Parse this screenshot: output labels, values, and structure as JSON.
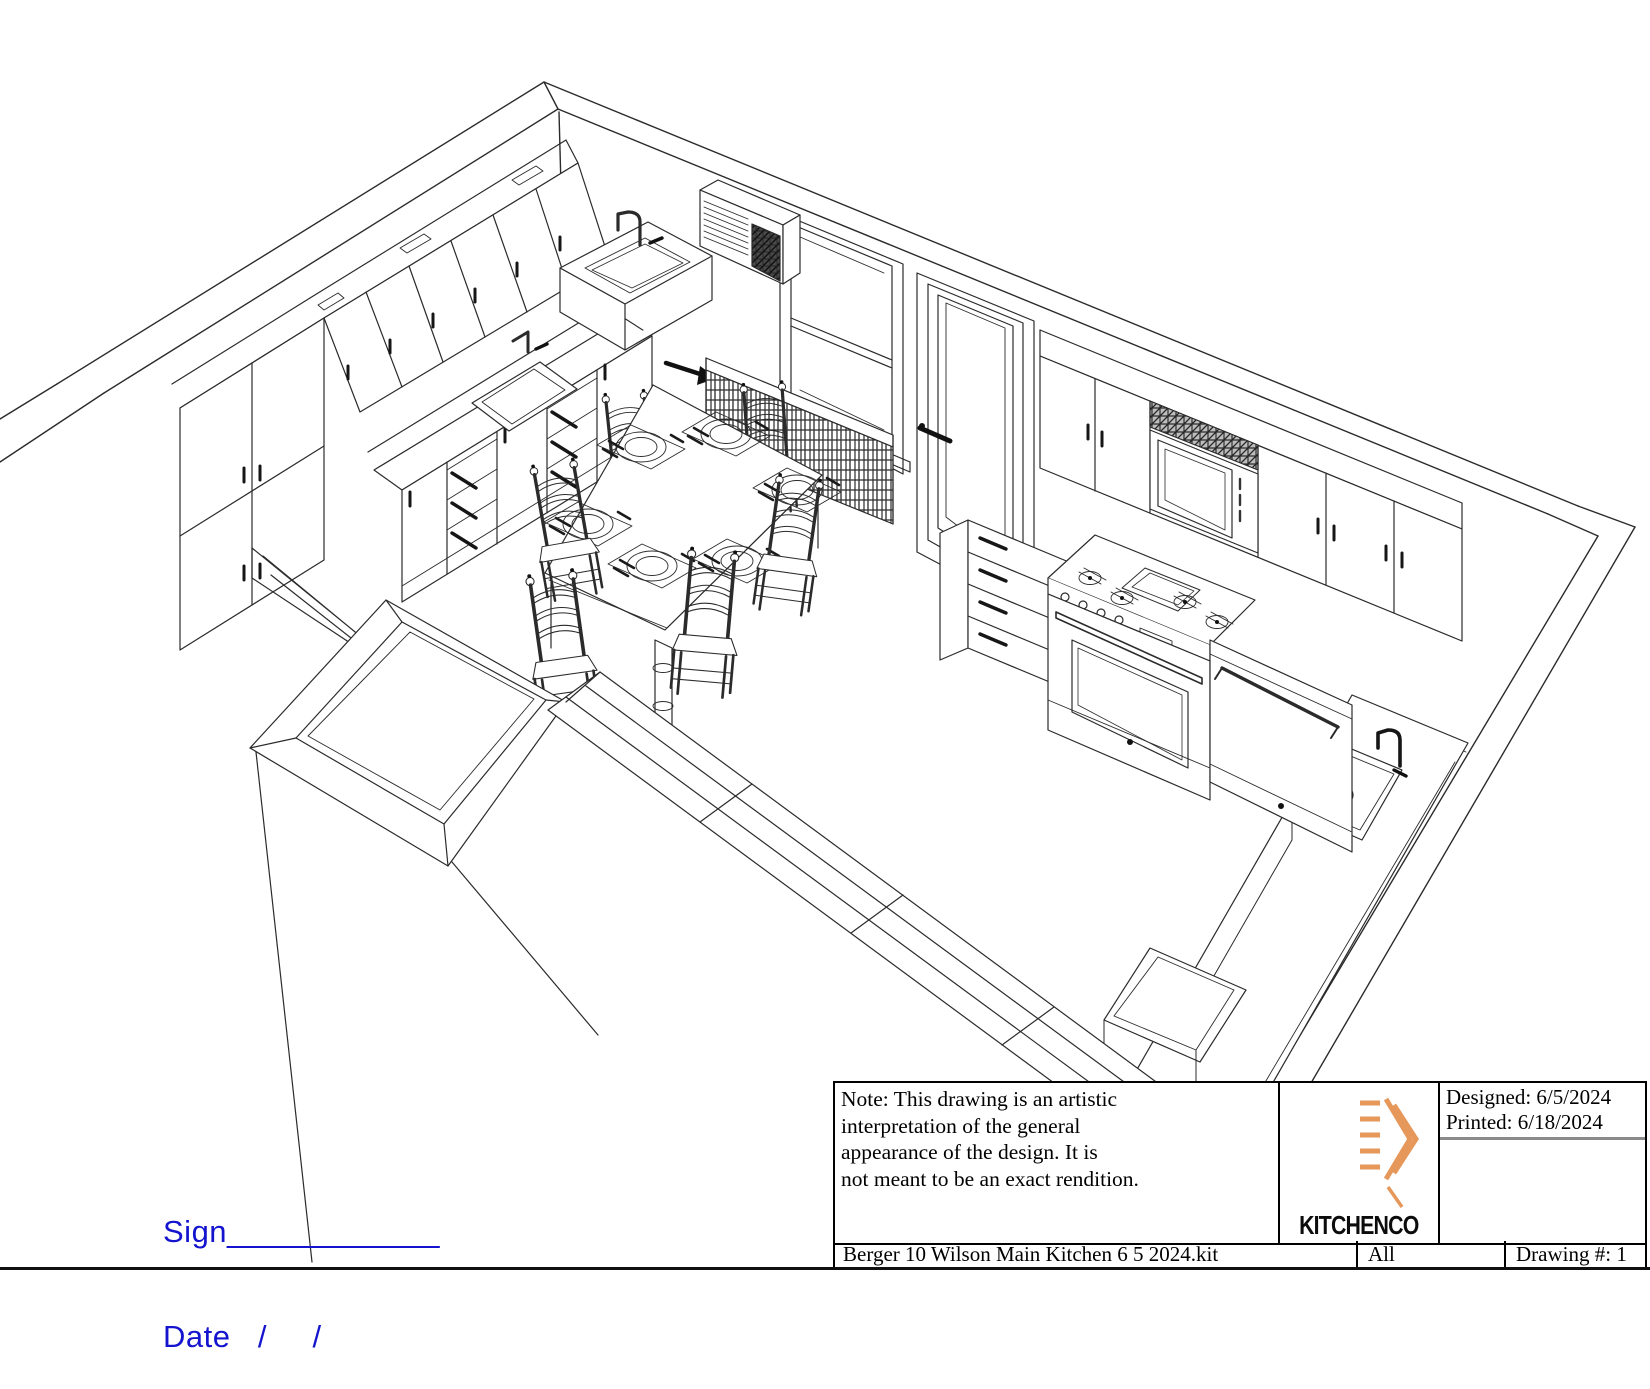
{
  "signature": {
    "sign_label": "Sign____________",
    "date_label": "Date   /     /",
    "color": "#1414cf"
  },
  "title_block": {
    "note_lines": [
      "Note: This drawing is an artistic",
      "interpretation of the general",
      "appearance of the design. It is",
      "not meant to be an exact rendition."
    ],
    "designed_label": "Designed: 6/5/2024",
    "printed_label": "Printed: 6/18/2024",
    "file_name": "Berger 10 Wilson Main Kitchen 6 5 2024.kit",
    "sheet": "All",
    "drawing_number": "Drawing #: 1",
    "logo_text": "KITCHENCO",
    "logo_accent_color": "#e6975a"
  },
  "drawing": {
    "line_color": "#2b2b2b",
    "content": "isometric wireframe rendering of kitchen: wall cabinets, two sinks, window with air conditioner, radiator, door, range, microwave, dishwasher, dining table with six chairs and place settings"
  }
}
